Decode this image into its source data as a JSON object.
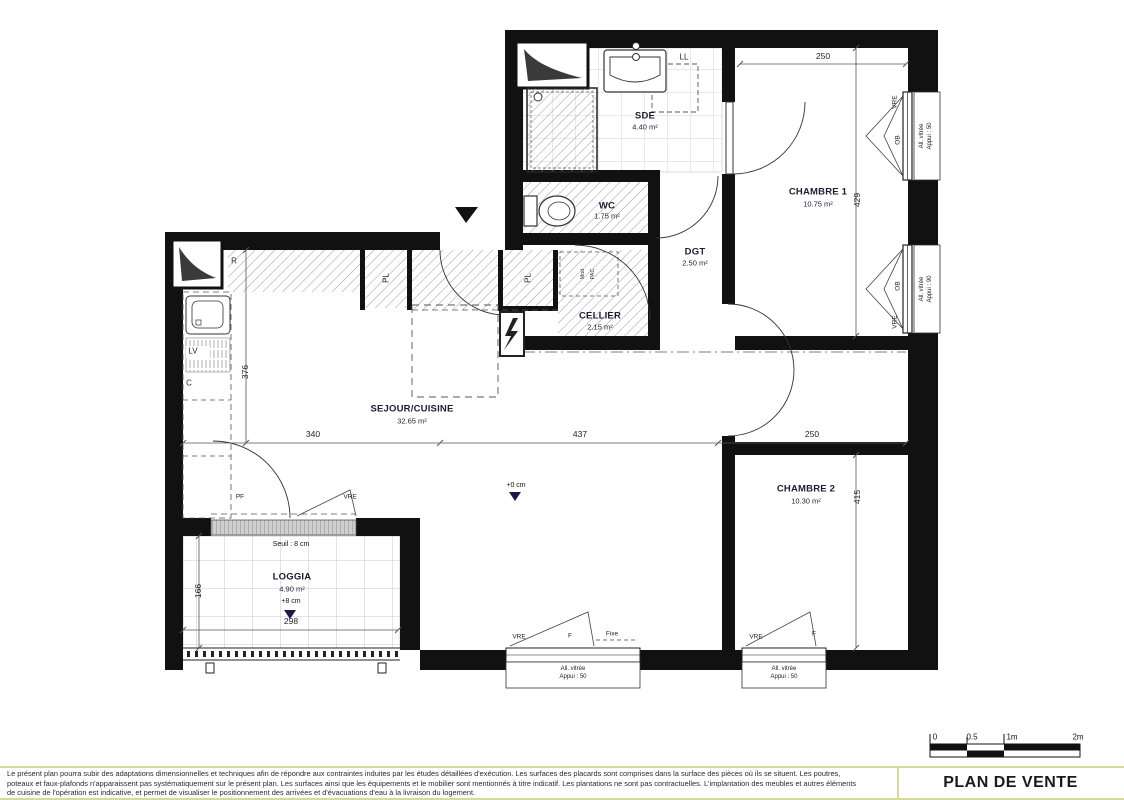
{
  "rooms": [
    {
      "name": "SDE",
      "area": "4.40 m²"
    },
    {
      "name": "WC",
      "area": "1.75 m²"
    },
    {
      "name": "DGT",
      "area": "2.50 m²"
    },
    {
      "name": "CHAMBRE 1",
      "area": "10.75 m²"
    },
    {
      "name": "CELLIER",
      "area": "2.15 m²"
    },
    {
      "name": "SEJOUR/CUISINE",
      "area": "32.65 m²"
    },
    {
      "name": "CHAMBRE 2",
      "area": "10.30 m²"
    },
    {
      "name": "LOGGIA",
      "area": "4.90 m²"
    }
  ],
  "dims": {
    "ch1_w": "250",
    "ch1_h": "429",
    "sej_h": "376",
    "sej_w": "340",
    "mid_w": "437",
    "ch2_w": "250",
    "ch2_h": "415",
    "log_h": "166",
    "log_w": "298"
  },
  "levels": {
    "sejour": "+0 cm",
    "loggia": "+8 cm",
    "seuil": "Seuil : 8 cm"
  },
  "fixtures": {
    "ll": "LL",
    "r": "R",
    "lv": "LV",
    "c": "C",
    "pl1": "PL",
    "pl2": "PL",
    "pac1": "Mod",
    "pac2": "PAC"
  },
  "windows": {
    "right1": {
      "vre": "VRE",
      "ob": "OB",
      "note": "All. vitrée",
      "appui": "Appui : 50"
    },
    "right2": {
      "ob": "OB",
      "vre": "VRE",
      "note": "All. vitrée",
      "appui": "Appui : 90"
    },
    "bottom1": {
      "vre": "VRE",
      "f": "F",
      "fixe": "Fixe",
      "note": "All. vitrée",
      "appui": "Appui : 50"
    },
    "bottom2": {
      "vre": "VRE",
      "f": "F",
      "note": "All. vitrée",
      "appui": "Appui : 50"
    },
    "loggia": {
      "pf": "PF",
      "vre": "VRE"
    }
  },
  "scalebar": {
    "t0": "0",
    "t05": "0.5",
    "t1": "1m",
    "t2": "2m"
  },
  "footer": {
    "line1": "Le présent plan pourra subir des adaptations dimensionnelles et techniques afin de répondre aux contraintes induites par les études détaillées d'exécution. Les surfaces des placards sont comprises dans la surface des pièces où ils se situent. Les poutres,",
    "line2": "poteaux et faux-plafonds n'apparaissent pas systématiquement sur le présent plan. Les surfaces ainsi que les équipements et le mobilier sont mentionnés à titre indicatif. Les plantations ne sont pas contractuelles. L'implantation des meubles et autres éléments",
    "line3": "de cuisine de l'opération est indicative, et permet de visualiser le positionnement des arrivées et d'évacuations d'eau à la livraison du logement.",
    "title": "PLAN DE VENTE"
  }
}
